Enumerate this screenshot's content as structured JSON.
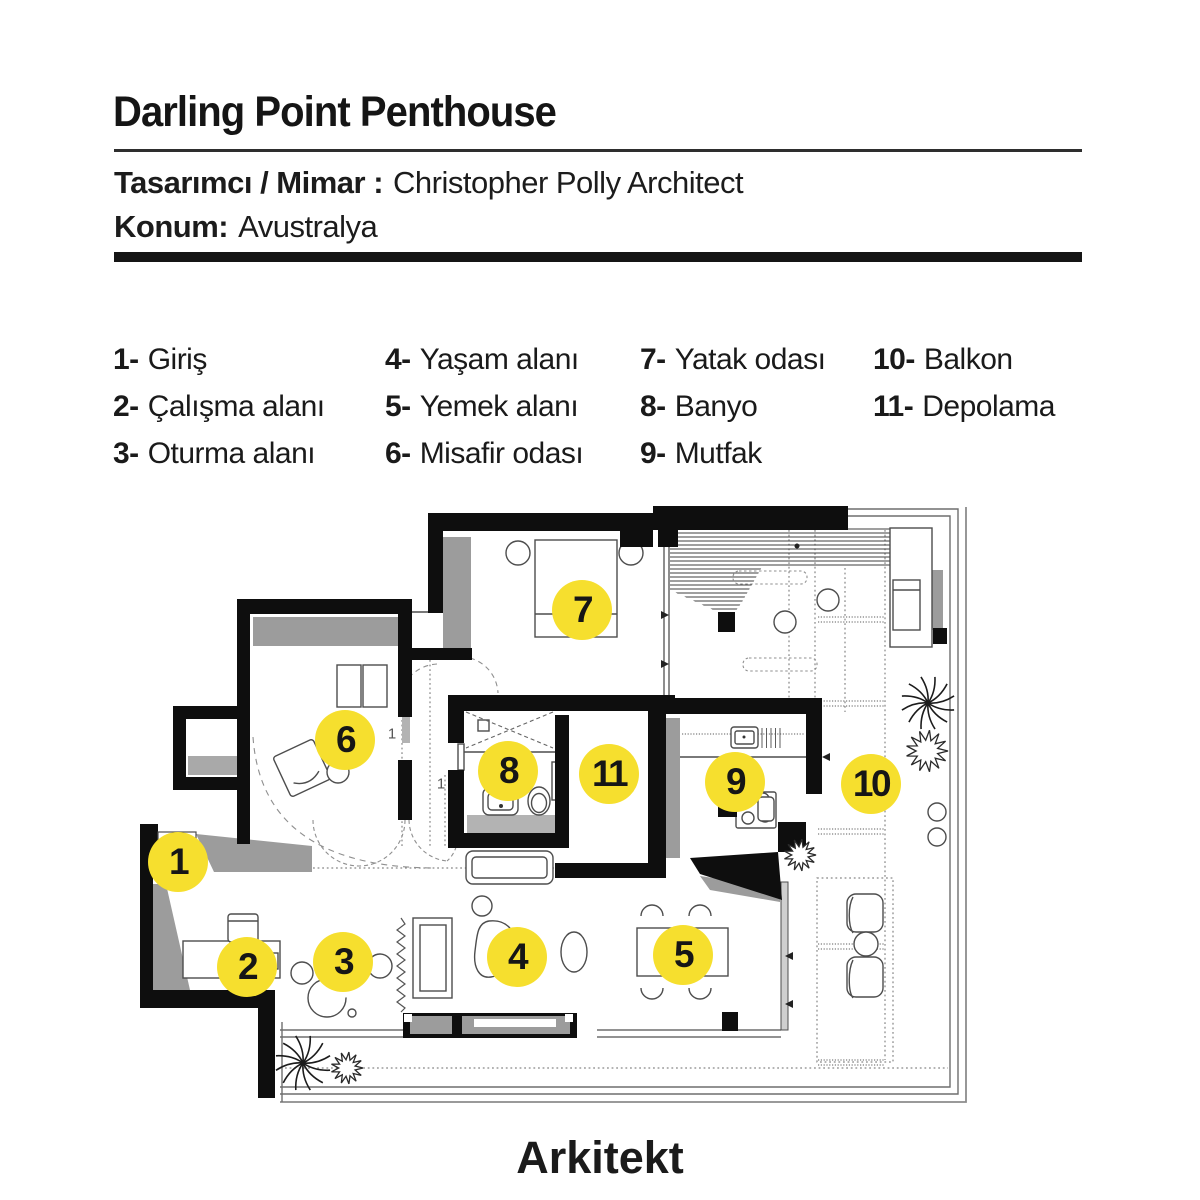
{
  "header": {
    "title": "Darling Point Penthouse",
    "designer_label": "Tasarımcı / Mimar :",
    "designer_value": "Christopher Polly Architect",
    "location_label": "Konum:",
    "location_value": "Avustralya"
  },
  "legend": {
    "items": [
      {
        "num": "1-",
        "label": "Giriş"
      },
      {
        "num": "2-",
        "label": "Çalışma alanı"
      },
      {
        "num": "3-",
        "label": "Oturma alanı"
      },
      {
        "num": "4-",
        "label": "Yaşam alanı"
      },
      {
        "num": "5-",
        "label": "Yemek alanı"
      },
      {
        "num": "6-",
        "label": "Misafir odası"
      },
      {
        "num": "7-",
        "label": "Yatak odası"
      },
      {
        "num": "8-",
        "label": "Banyo"
      },
      {
        "num": "9-",
        "label": "Mutfak"
      },
      {
        "num": "10-",
        "label": "Balkon"
      },
      {
        "num": "11-",
        "label": "Depolama"
      }
    ]
  },
  "floorplan": {
    "accent_yellow": "#f6df2e",
    "wall_black": "#0e0e0e",
    "markers": [
      {
        "num": "1",
        "x": 178,
        "y": 862
      },
      {
        "num": "2",
        "x": 247,
        "y": 967
      },
      {
        "num": "3",
        "x": 343,
        "y": 962
      },
      {
        "num": "4",
        "x": 517,
        "y": 957
      },
      {
        "num": "5",
        "x": 683,
        "y": 955
      },
      {
        "num": "6",
        "x": 345,
        "y": 740
      },
      {
        "num": "7",
        "x": 582,
        "y": 610
      },
      {
        "num": "8",
        "x": 508,
        "y": 771
      },
      {
        "num": "9",
        "x": 735,
        "y": 782
      },
      {
        "num": "10",
        "x": 871,
        "y": 784
      },
      {
        "num": "11",
        "x": 609,
        "y": 774
      }
    ],
    "door_labels": [
      {
        "text": "1",
        "x": 392,
        "y": 734
      },
      {
        "text": "1",
        "x": 441,
        "y": 784
      }
    ]
  },
  "footer": {
    "logo": "Arkitekt"
  }
}
